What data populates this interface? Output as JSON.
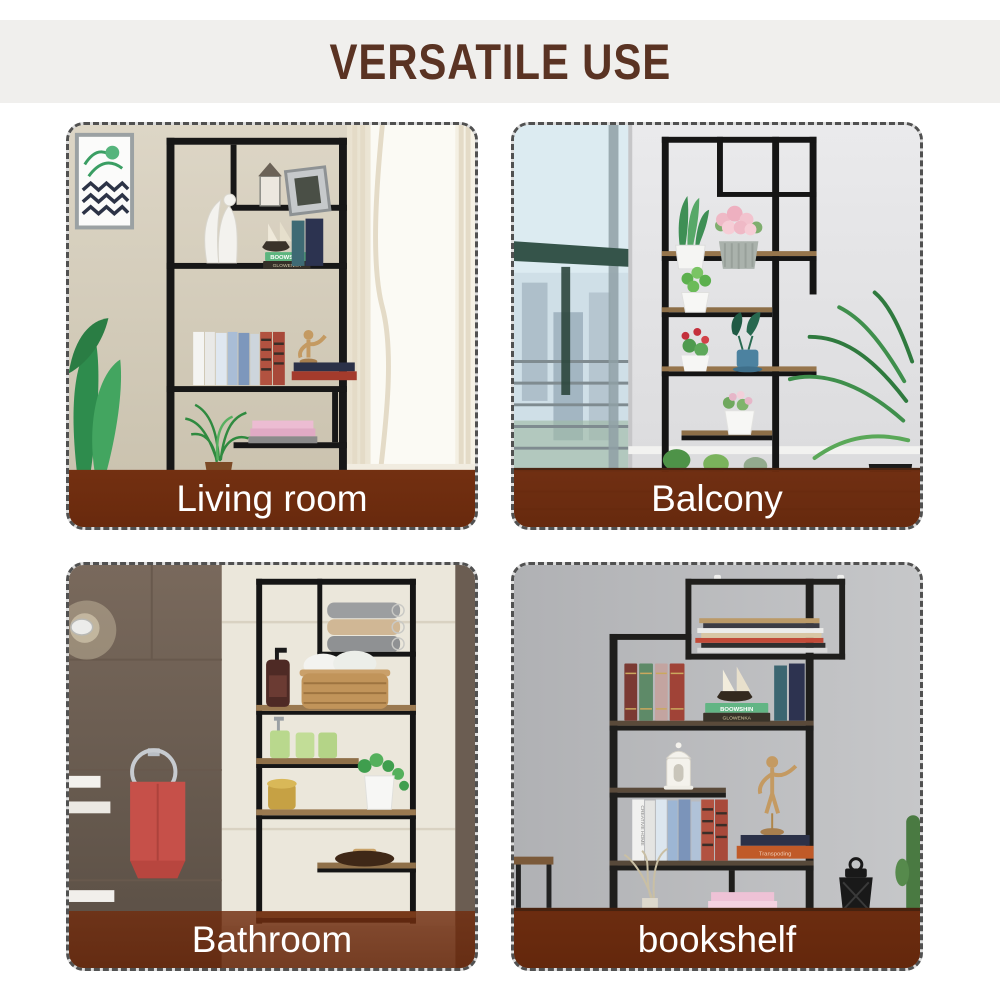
{
  "header": {
    "title": "VERSATILE USE"
  },
  "panels": [
    {
      "id": "living-room",
      "label": "Living room"
    },
    {
      "id": "balcony",
      "label": "Balcony"
    },
    {
      "id": "bathroom",
      "label": "Bathroom"
    },
    {
      "id": "bookshelf",
      "label": "bookshelf"
    }
  ],
  "decor_text": {
    "green_book": "BOOWSHIN",
    "dark_book": "GLOWENKA",
    "white_book": "CREATIVE HOME",
    "orange_book": "Transpoding"
  },
  "colors": {
    "page_bg": "#ffffff",
    "title_text": "#5a3323",
    "title_band_bg": "#f0efed",
    "panel_border": "#515151",
    "label_overlay": "rgba(110,44,15,0.85)",
    "label_text": "#ffffff",
    "shelf_metal": "#1a1a1a"
  }
}
